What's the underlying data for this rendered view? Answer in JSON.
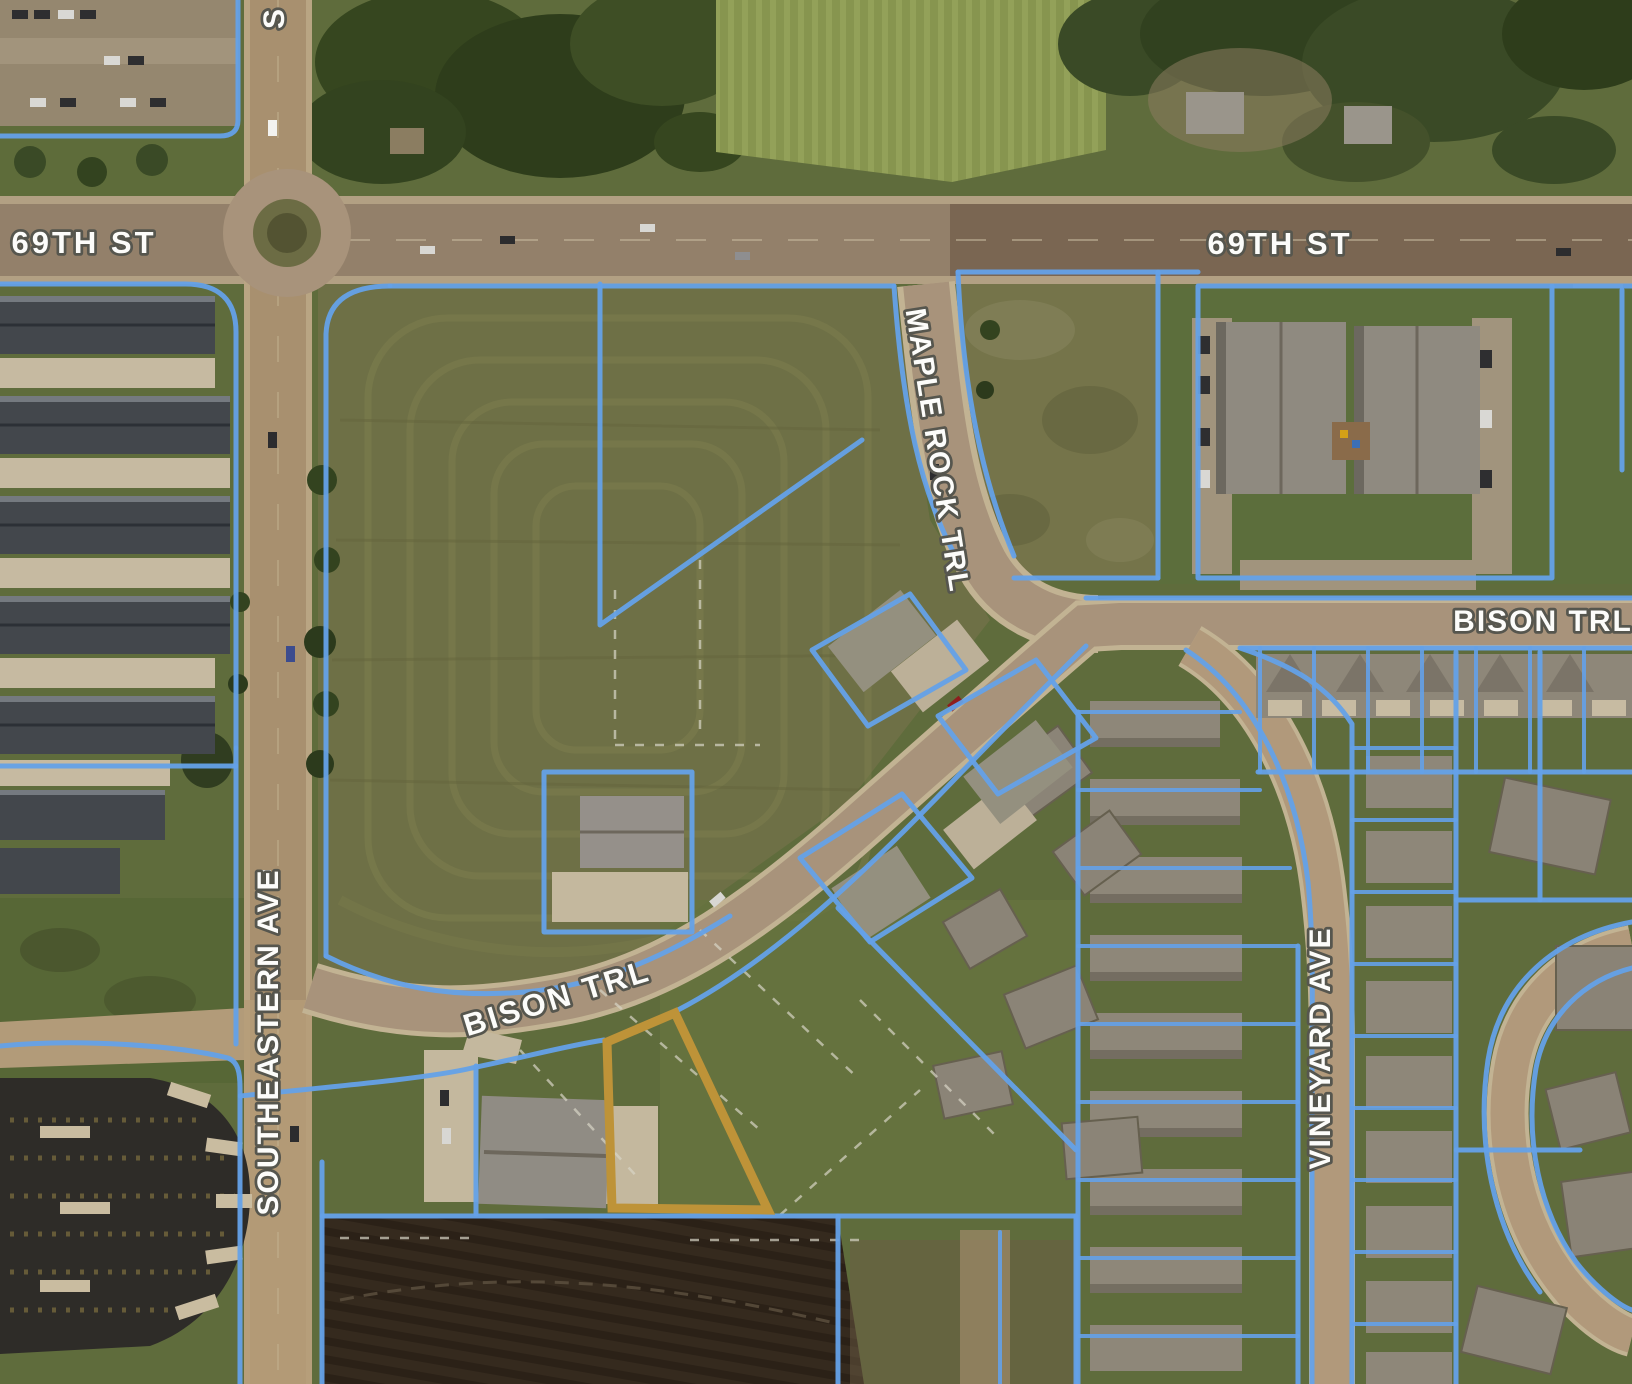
{
  "map": {
    "description": "Aerial GIS parcel map with blue parcel boundaries and one gold highlighted parcel",
    "colors": {
      "parcel_line": "#64a1e8",
      "highlight_outline": "#be9338",
      "label_fill": "#fcfcfa",
      "label_outline": "#56564e"
    },
    "street_labels": [
      {
        "id": "69th-st-west",
        "text": "69TH ST",
        "x": 84,
        "y": 253,
        "rotation": 0,
        "font_size": 31,
        "letter_spacing": 3
      },
      {
        "id": "69th-st-east",
        "text": "69TH ST",
        "x": 1280,
        "y": 254,
        "rotation": 0,
        "font_size": 31,
        "letter_spacing": 3
      },
      {
        "id": "street-partial-north",
        "text": "S",
        "x": 284,
        "y": 18,
        "rotation": -90,
        "font_size": 30,
        "letter_spacing": 2
      },
      {
        "id": "maple-rock-trl",
        "text": "MAPLE ROCK TRL",
        "x": 928,
        "y": 452,
        "rotation": 81,
        "font_size": 29,
        "letter_spacing": 2
      },
      {
        "id": "bison-trl-east",
        "text": "BISON TRL",
        "x": 1543,
        "y": 631,
        "rotation": 0,
        "font_size": 30,
        "letter_spacing": 2
      },
      {
        "id": "bison-trl-west",
        "text": "BISON TRL",
        "x": 560,
        "y": 1008,
        "rotation": -17,
        "font_size": 31,
        "letter_spacing": 3
      },
      {
        "id": "southeastern-ave",
        "text": "SOUTHEASTERN AVE",
        "x": 278,
        "y": 1042,
        "rotation": -90,
        "font_size": 30,
        "letter_spacing": 2
      },
      {
        "id": "vineyard-ave",
        "text": "VINEYARD AVE",
        "x": 1330,
        "y": 1048,
        "rotation": -90,
        "font_size": 30,
        "letter_spacing": 2
      }
    ],
    "highlighted_parcel": {
      "points": "675,1013 607,1042 612,1208 768,1210",
      "outline_color": "#be9338",
      "outline_width": 9
    }
  }
}
